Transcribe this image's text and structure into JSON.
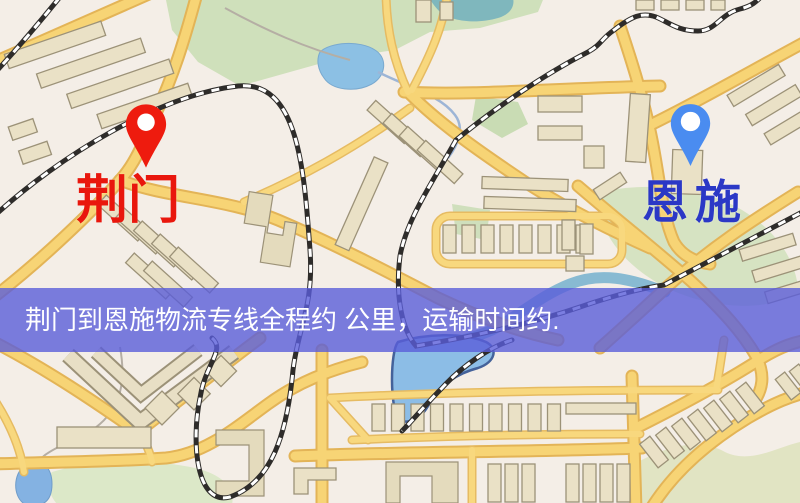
{
  "map": {
    "origin_marker": {
      "label": "荆门",
      "label_color": "#e9170d",
      "pin_color": "#ee1b0e"
    },
    "destination_marker": {
      "label": "恩施",
      "label_color": "#2b38c6",
      "pin_color": "#4a8cf0"
    }
  },
  "banner": {
    "text": "荆门到恩施物流专线全程约 公里，运输时间约.",
    "background": "rgba(90,94,218,0.80)",
    "text_color": "#ffffff"
  },
  "colors": {
    "map_background": "#f4eee7",
    "road_fill": "#f7d475",
    "road_casing": "#e3b457",
    "railway": "#2e2c2a",
    "building_fill": "#eae1c6",
    "park_green": "#cfe0bb",
    "water_blue": "#8cc0e4"
  }
}
